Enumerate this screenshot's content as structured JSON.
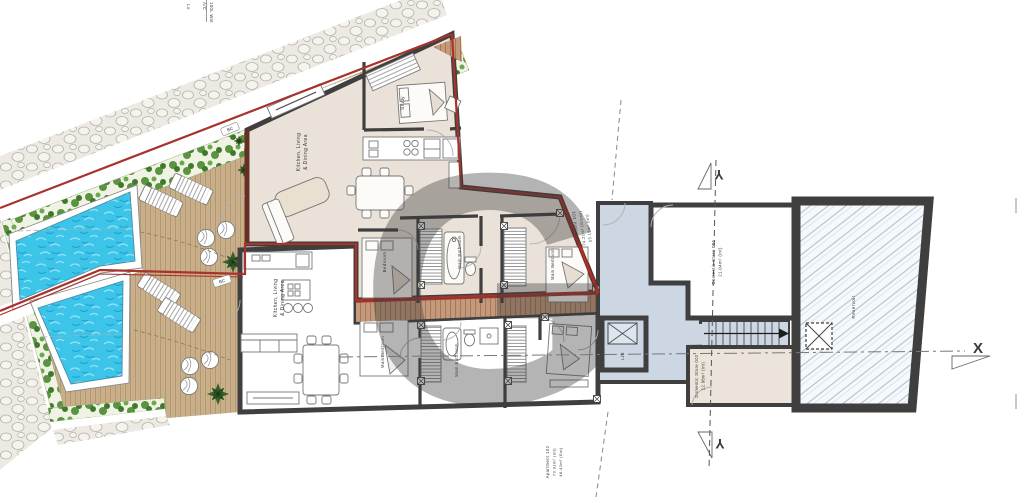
{
  "title": "Floor plan",
  "site": {
    "boundary_chip_1": "BC",
    "boundary_chip_2": "BC",
    "top_edge_note_1": "Lo",
    "top_edge_note_2": "A/C",
    "top_edge_note_3": "100L Wat"
  },
  "upper_apartment": {
    "id_line1": "Apartment 101",
    "id_line2": "74.21m² (Gross)",
    "id_line3": "53.19m² (Int)",
    "kitchen_line1": "Kitchen, Living",
    "kitchen_line2": "& Dining Area",
    "study": "Study",
    "bedroom": "Bedroom",
    "bathroom": "Main Bathroom",
    "main_bedroom": "Main Bedroom"
  },
  "lower_apartment": {
    "id_line1": "Apartment 102",
    "id_line2": "73.91m² (Int)",
    "id_line3": "48.42m² (Ext)",
    "kitchen_line1": "Kitchen, Living",
    "kitchen_line2": "& Dining Area",
    "main_bedroom": "Main Bedroom",
    "bathroom": "Main Bathroom"
  },
  "core": {
    "lift": "Lift",
    "store1_line1": "Domestic Store 001",
    "store1_line2": "21.04m² (int)",
    "store2_line1": "Domestic Store 002",
    "store2_line2": "12.98m² (int)"
  },
  "reservoir": {
    "label": "Reservoir"
  },
  "markers": {
    "x": "X",
    "y_top": "Y",
    "y_bottom": "Y"
  },
  "watermark": {
    "letter": "G"
  },
  "colors": {
    "boundary_red": "#a8322c",
    "wall": "#3f3f3f",
    "pool_water": "#3cc4e9",
    "deck_wood": "#cbb18b",
    "circulation": "#ccd7e3",
    "upper_floor": "#eae2d8",
    "watermark": "#ef9a8d"
  }
}
